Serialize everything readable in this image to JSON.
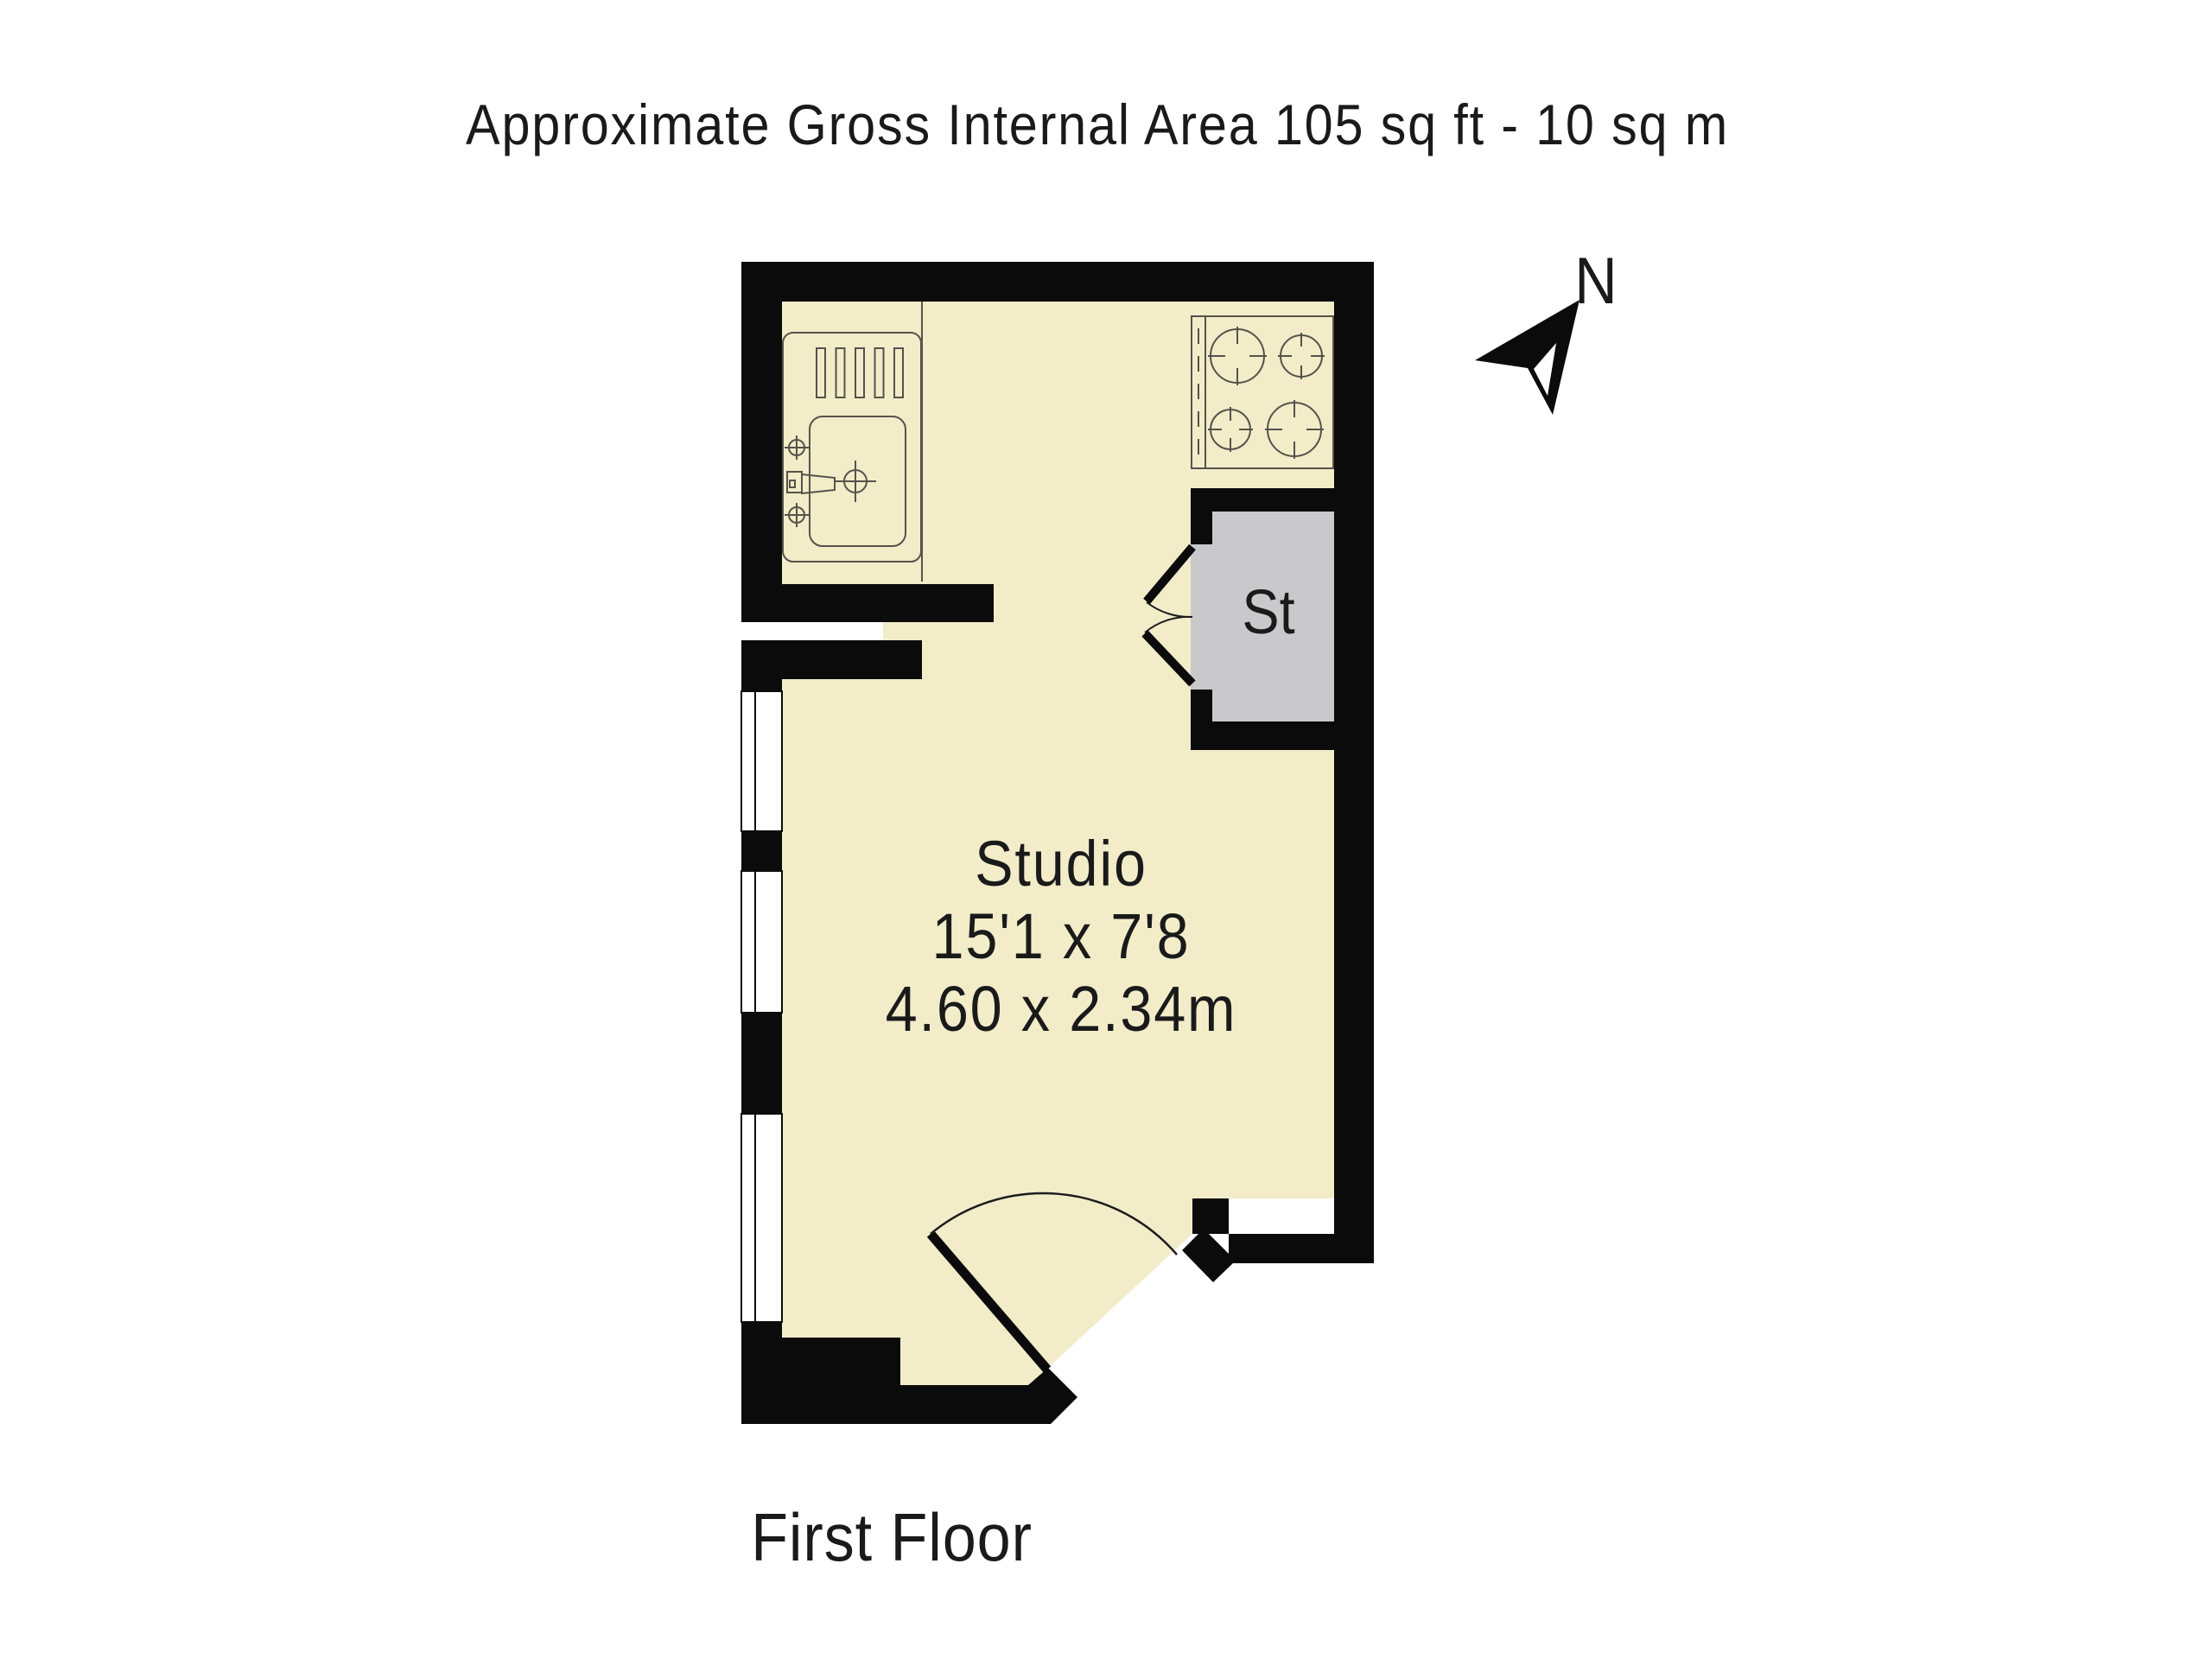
{
  "header": {
    "title": "Approximate Gross Internal Area 105 sq ft - 10 sq m"
  },
  "compass": {
    "north_label": "N"
  },
  "plan": {
    "room": {
      "name": "Studio",
      "dims_imperial": "15'1 x 7'8",
      "dims_metric": "4.60 x 2.34m"
    },
    "storage": {
      "label": "St"
    },
    "fixtures": [
      "kitchen-sink-unit-icon",
      "drainer-icon",
      "taps-icon",
      "hob-4-burners-icon",
      "storage-bifold-doors-icon",
      "entry-door-swing-icon",
      "window-icon",
      "window-icon",
      "window-icon"
    ]
  },
  "footer": {
    "floor_label": "First Floor"
  },
  "colors": {
    "background": "#ffffff",
    "wall": "#0b0b0b",
    "floor": "#f2ecc9",
    "storage": "#c9c9cb",
    "line": "#55534a",
    "text": "#1a1a1a"
  }
}
